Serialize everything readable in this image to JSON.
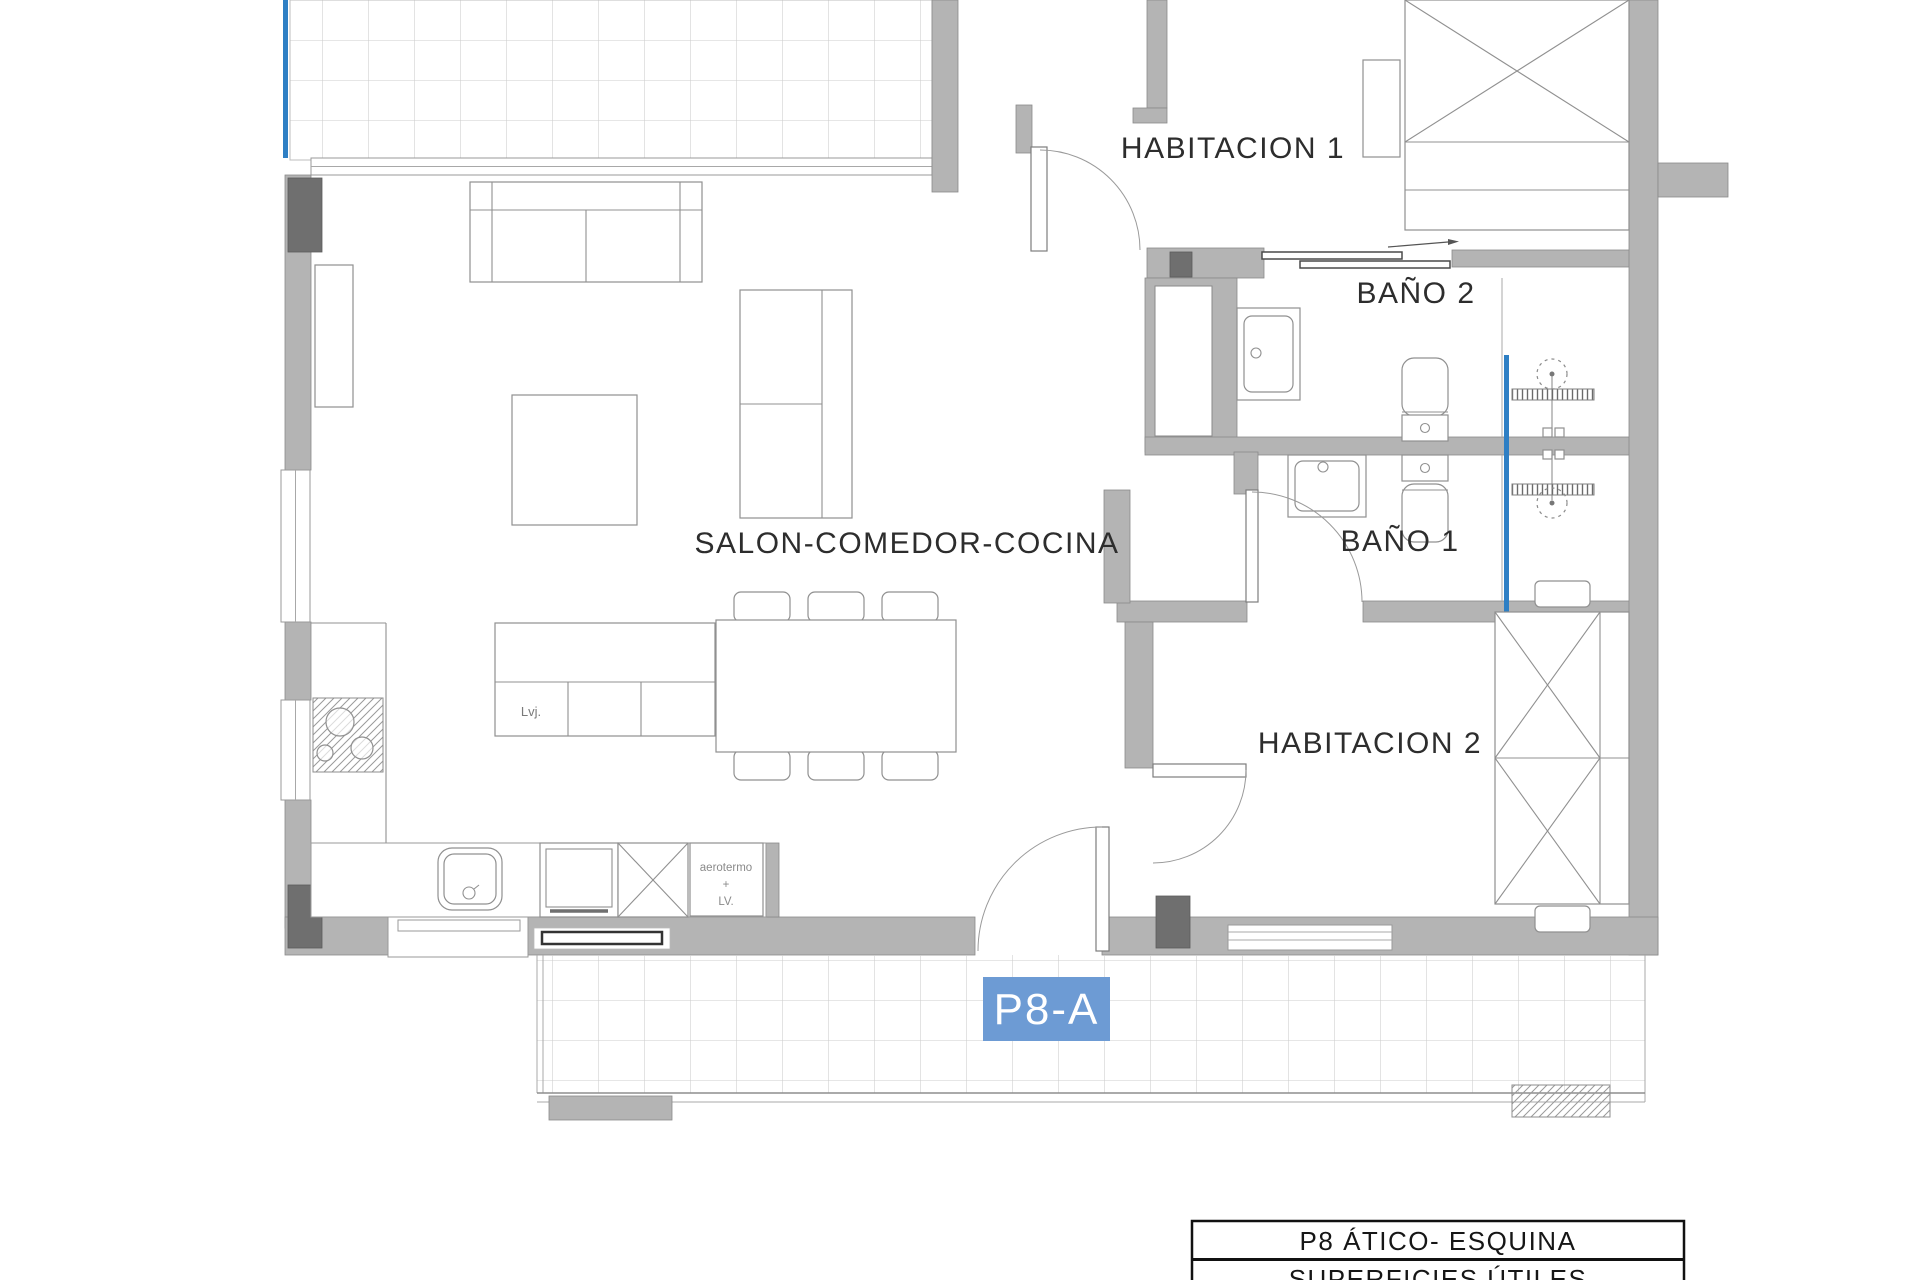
{
  "labels": {
    "habitacion1": "HABITACION 1",
    "habitacion2": "HABITACION 2",
    "bano2": "BAÑO 2",
    "bano1": "BAÑO 1",
    "salon": "SALON-COMEDOR-COCINA",
    "island": "Lvj.",
    "aerotermo_line1": "aerotermo",
    "aerotermo_line2": "+",
    "aerotermo_line3": "LV.",
    "unit_badge": "P8-A"
  },
  "title_block": {
    "row1": "P8 ÁTICO- ESQUINA",
    "row2": "SUPERFICIES ÚTILES"
  },
  "colors": {
    "accent_blue": "#2e7fc4",
    "badge_blue": "#6d9bd4",
    "wall_gray": "#b4b4b4",
    "dark_gray": "#6f6f6f"
  }
}
